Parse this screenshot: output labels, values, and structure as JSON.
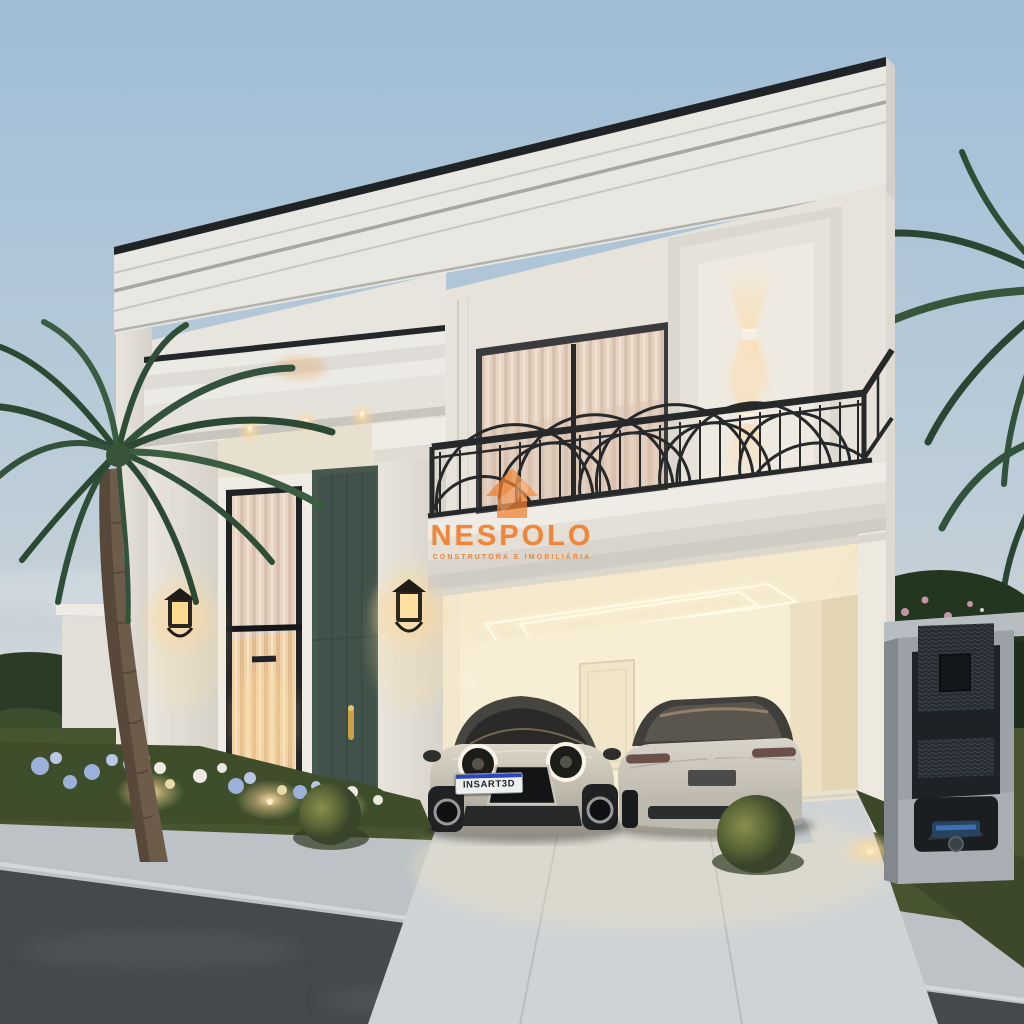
{
  "watermark": {
    "brand": "NESPOLO",
    "tagline": "CONSTRUTORA E IMOBILIÁRIA",
    "logo_icon": "nespolo-house-logo-icon",
    "color": "#EF7F2F"
  },
  "vehicles": [
    {
      "name": "mini-hatchback-front",
      "body_color": "silver",
      "license_plate": "INSART3D",
      "plate_strip_color": "#2A46B8"
    },
    {
      "name": "luxury-sedan-rear",
      "body_color": "silver"
    }
  ],
  "palette": {
    "sky_top": "#9FBDD7",
    "sky_horizon": "#DCDCDA",
    "wall_light": "#EAE7E0",
    "wall_shadow": "#D5D2CA",
    "garage_glow": "#F8ECCF",
    "front_door_green": "#47584F",
    "railing_black": "#26282A",
    "palm_green": "#33523B",
    "grass_dusk": "#4E5D33",
    "asphalt": "#45494D",
    "sidewalk": "#BCC2C6",
    "driveway": "#CFD3D6",
    "watermark_orange": "#EF7F2F",
    "lantern_warm": "#FFD89A"
  }
}
